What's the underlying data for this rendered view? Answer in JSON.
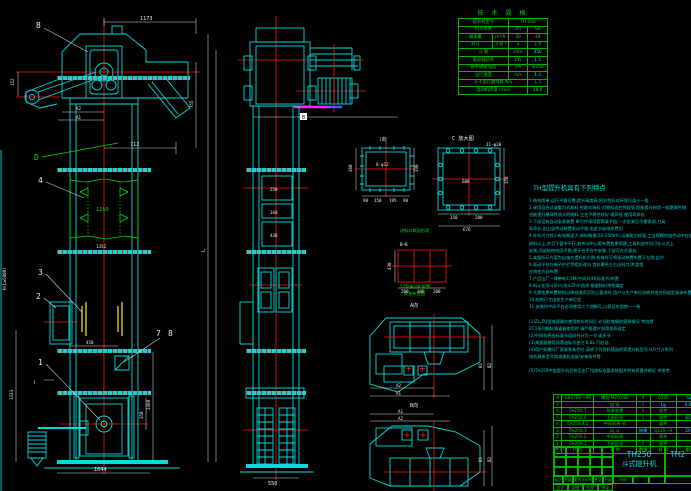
{
  "colors": {
    "line_cyan": "#00dcdc",
    "line_red": "#ff1515",
    "line_green": "#00d800",
    "line_yellow": "#ffee00",
    "dim_white": "#ececec",
    "table_green": "#00d400",
    "magenta": "#ff22ff",
    "background": "#000000"
  },
  "fv": {
    "c8": "8",
    "c4": "4",
    "c3": "3",
    "c2": "2",
    "c1": "1",
    "c7": "7",
    "c8b": "8",
    "cD": "D",
    "cI": "Ⅰ",
    "d1173": "1173",
    "d712": "712",
    "dA2": "A2",
    "dA1": "A1",
    "d152": "152",
    "d755": "755",
    "dL": "L",
    "d1150": "1150",
    "d1352": "1352",
    "dH": "H(L≥5000)",
    "d450": "450",
    "d1460": "1460",
    "d350": "350",
    "d1333": "1333",
    "d1044": "1044"
  },
  "sv": {
    "dB": "B",
    "d250": "250",
    "d160": "160",
    "d438": "438",
    "d550": "550"
  },
  "vI": {
    "label": "Ⅰ向",
    "holes": "8-φ12",
    "l360": "360",
    "r330": "330",
    "b90a": "90",
    "b150": "150",
    "b195": "195",
    "b90b": "90"
  },
  "vC": {
    "label": "C 放大图",
    "holes": "11-φ20",
    "inner": "600",
    "b150": "150",
    "b200": "200",
    "total": "676",
    "r350": "350"
  },
  "vB": {
    "label": "进料口断面形状",
    "sec": "B—B",
    "h430": "430",
    "b200a": "200",
    "b300": "300",
    "b200b": "200"
  },
  "p1": {
    "note1": "Y2型电动机配置",
    "note2": "安装布置图",
    "label": "A向",
    "a2": "A2",
    "a1": "A1",
    "b1": "B1",
    "b2": "B2"
  },
  "p2": {
    "label": "B向",
    "a1": "A1",
    "a2": "A2",
    "b1": "B1",
    "b2": "B2"
  },
  "tech": {
    "title": "技 术 规 格",
    "rows": [
      [
        {
          "t": "提升机型号",
          "s": 2
        },
        {
          "t": "TH 250",
          "s": 2
        }
      ],
      [
        {
          "t": "料斗形式",
          "s": 2
        },
        {
          "t": "Zh"
        },
        {
          "t": "Sh"
        }
      ],
      [
        {
          "t": "输送量"
        },
        {
          "t": "m³/h"
        },
        {
          "t": "30"
        },
        {
          "t": "48"
        }
      ],
      [
        {
          "t": "料斗"
        },
        {
          "t": "斗容 l"
        },
        {
          "t": "3"
        },
        {
          "t": "1.9"
        }
      ],
      [
        {
          "t": "斗 距",
          "s": 2
        },
        {
          "t": "mm"
        },
        {
          "t": "350",
          "c": 1
        }
      ],
      [
        {
          "t": "驱动轴功率",
          "s": 2
        },
        {
          "t": "kW"
        },
        {
          "t": "1.5",
          "c": 1
        }
      ],
      [
        {
          "t": "链条破断强度",
          "s": 2
        },
        {
          "t": "kN"
        },
        {
          "t": "≥250"
        }
      ],
      [
        {
          "t": "运行速度",
          "s": 2
        },
        {
          "t": "m/s"
        },
        {
          "t": "1.4",
          "c": 1
        }
      ],
      [
        {
          "t": "斗子运行曲线数 N/S",
          "s": 3
        },
        {
          "t": "1.5"
        }
      ],
      [
        {
          "t": "电动机转速 r/min",
          "s": 3
        },
        {
          "t": "48.8"
        }
      ]
    ]
  },
  "notes": {
    "title": "TH型提升机具有下列特点",
    "lines": [
      "1.结构简单,运行平稳可靠,提升高度高,密封性好对环境污染小—般",
      "2.采用混合式或重力式卸料 挖取式装料 对物料适应性较强 既能提升粉状—般磨琢性物",
      "  也能提升磨琢性较大的物料 工艺平稳性较好 噪声低 使用寿命长",
      "3.下部设有自动张紧装置 牵引件采用套筒滚子链,一次张紧后不需常调,刀具",
      "  寿命长,由上部传动装置驱动平稳,由此节省维修费用",
      "4.外形尺寸较小有效断面大,卸料畅通(50-250t/h),运输能力较强,工业规模的链传动中在较",
      "  卸料斗上,并且下管中平行,其传动中心距布置变更简便,工具和部件均可在斗式上",
      "  安装,顶部结构牢固平稳,便于在平台中安装 下部可在任意处",
      "5.本图所示方案为出轴在提升机右侧 检修时可将驱动装置布置于左侧,此时",
      "6.驱动平台与梯子护栏等相应改向              首轮罩壳左右出料口/井盖相",
      "  应改变方向布置",
      "7.产品出厂一律带有4.5M(中间节)H(标准节)布置",
      "8.料斗在深斗Sh与浅斗Zh中选择 根据物料特性确定",
      "9.凡需变更布置结构以降低噪声及防尘要求时,用户与生产单位协商并由合同规定具体布置",
      "10.结构尺寸由各生产单位定",
      "11.安装时中间平台必须使用二个地脚孔,以保证牢固统一一致",
      "",
      "(1)ZL,ZQ型减速器在使用较长时间后 必须检查蜗轮磨损情况 特别是",
      "  ZC1系列蜗轮减速器使用时 请严格遵守润滑保养规定",
      "(2)中间机壳由标准节组成共计为一节 或多节",
      "(3)减速器按照润滑油标号加注 6.8L 汽缸油",
      "(4)用户如需同厂家联系条件时 请将下列资料随函附寄提升机型号 H尺寸,Y系列",
      "  电机具体型号和减速机连接/安装条件等",
      "",
      "(5)TH250中由提升机总装至出厂均按标准要求装配并附有质量合格证 供参考."
    ]
  },
  "bom": {
    "headers": [
      "件号",
      "代  号",
      "名  称",
      "数量",
      "材 料",
      "重量"
    ],
    "rows": [
      {
        "c": [
          "8",
          "GB5782—86",
          "螺栓 M20×80",
          "4",
          "Q235",
          "GB"
        ],
        "y": [
          5
        ]
      },
      {
        "c": [
          "7",
          "",
          "链  条",
          "1",
          "Lg",
          "6.05"
        ],
        "y": [
          4,
          5
        ]
      },
      {
        "c": [
          "6",
          "TH250.7",
          "张紧装置",
          "1",
          "部件",
          ""
        ],
        "y": []
      },
      {
        "c": [
          "5",
          "TH250.6",
          "上部区段",
          "1",
          "部件",
          "650"
        ],
        "y": [
          5
        ]
      },
      {
        "c": [
          "4",
          "TH250.4,5",
          "中间机壳·节",
          "",
          "部件",
          ""
        ],
        "y": []
      },
      {
        "c": [
          "3",
          "TH250.3",
          "料  斗",
          "按需",
          "Q235—A",
          "205"
        ],
        "y": [
          3,
          5
        ]
      },
      {
        "c": [
          "2",
          "TH250.2",
          "中部机壳",
          "",
          "部件",
          ""
        ],
        "y": []
      },
      {
        "c": [
          "1",
          "TH250.1",
          "下部区段",
          "1",
          "部件",
          ""
        ],
        "y": []
      }
    ]
  },
  "tb": {
    "model": "TH250",
    "name": "斗式提升机",
    "right": "TH2",
    "scale": "比例",
    "rev1": [
      "标记",
      "处数",
      "更改文件号",
      "签字",
      "日期"
    ],
    "rev2": [
      "设计",
      "制图",
      "校核",
      "审定"
    ]
  }
}
